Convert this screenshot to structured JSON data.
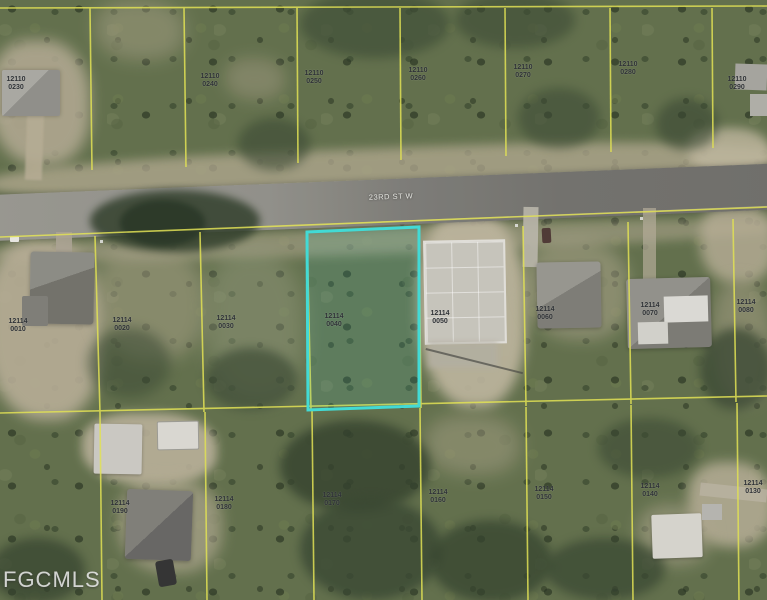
{
  "meta": {
    "width": 767,
    "height": 600,
    "kind": "aerial parcel map photo (MLS listing)"
  },
  "watermark": {
    "text": "FGCMLS"
  },
  "street": {
    "label": "23RD ST W"
  },
  "highlight": {
    "color": "#3bdcd6",
    "fill_opacity": 0.12,
    "strap": "12114",
    "lot": "0040"
  },
  "colors": {
    "parcel_line": "#e3e34f",
    "road": "#7d7c77",
    "label_text": "#262a2e",
    "watermark_text": "#eeeeee"
  },
  "parcel_labels": [
    {
      "x": 16,
      "y": 76,
      "strap": "12110",
      "lot": "0230"
    },
    {
      "x": 210,
      "y": 73,
      "strap": "12110",
      "lot": "0240"
    },
    {
      "x": 314,
      "y": 70,
      "strap": "12110",
      "lot": "0250"
    },
    {
      "x": 418,
      "y": 67,
      "strap": "12110",
      "lot": "0260"
    },
    {
      "x": 523,
      "y": 64,
      "strap": "12110",
      "lot": "0270"
    },
    {
      "x": 628,
      "y": 61,
      "strap": "12110",
      "lot": "0280"
    },
    {
      "x": 737,
      "y": 76,
      "strap": "12110",
      "lot": "0290"
    },
    {
      "x": 18,
      "y": 318,
      "strap": "12114",
      "lot": "0010"
    },
    {
      "x": 122,
      "y": 317,
      "strap": "12114",
      "lot": "0020"
    },
    {
      "x": 226,
      "y": 315,
      "strap": "12114",
      "lot": "0030"
    },
    {
      "x": 334,
      "y": 313,
      "strap": "12114",
      "lot": "0040"
    },
    {
      "x": 440,
      "y": 310,
      "strap": "12114",
      "lot": "0050"
    },
    {
      "x": 545,
      "y": 306,
      "strap": "12114",
      "lot": "0060"
    },
    {
      "x": 650,
      "y": 302,
      "strap": "12114",
      "lot": "0070"
    },
    {
      "x": 746,
      "y": 299,
      "strap": "12114",
      "lot": "0080"
    },
    {
      "x": 120,
      "y": 500,
      "strap": "12114",
      "lot": "0190"
    },
    {
      "x": 224,
      "y": 496,
      "strap": "12114",
      "lot": "0180"
    },
    {
      "x": 332,
      "y": 492,
      "strap": "12114",
      "lot": "0170"
    },
    {
      "x": 438,
      "y": 489,
      "strap": "12114",
      "lot": "0160"
    },
    {
      "x": 544,
      "y": 486,
      "strap": "12114",
      "lot": "0150"
    },
    {
      "x": 650,
      "y": 483,
      "strap": "12114",
      "lot": "0140"
    },
    {
      "x": 753,
      "y": 480,
      "strap": "12114",
      "lot": "0130"
    }
  ]
}
